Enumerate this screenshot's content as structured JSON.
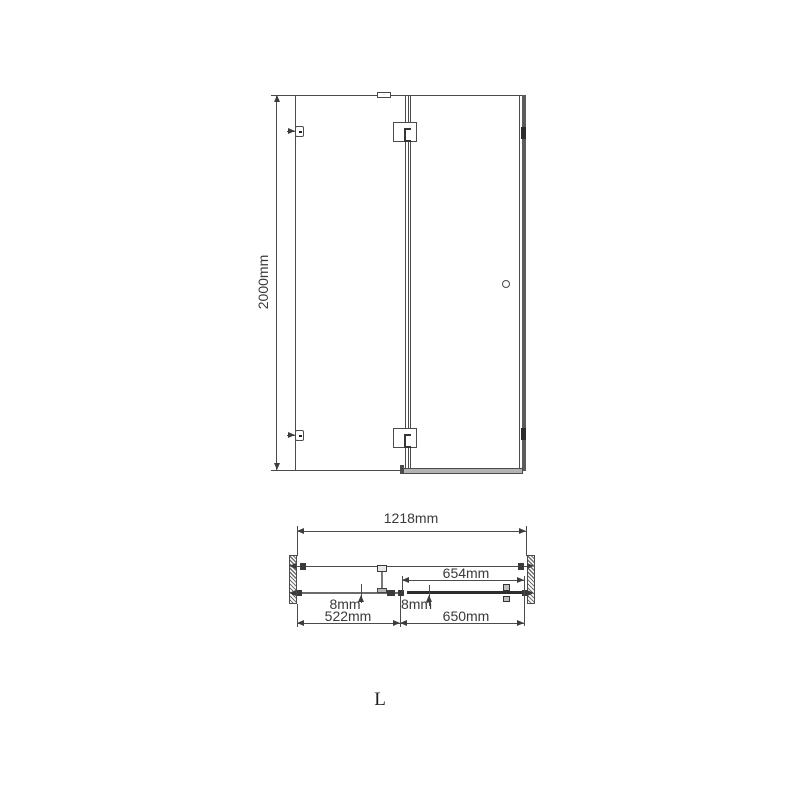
{
  "labels": {
    "height": "2000mm",
    "overall_width": "1218mm",
    "pivot_width": "654mm",
    "fixed_thickness": "8mm",
    "door_thickness": "8mm",
    "fixed_width": "522mm",
    "door_width": "650mm",
    "orientation": "L"
  },
  "colors": {
    "background": "#ffffff",
    "line": "#4b4b4b",
    "text": "#3a3a3a",
    "wall_profile": "#5c5c5c",
    "door_glass": "#2d2d2d"
  }
}
